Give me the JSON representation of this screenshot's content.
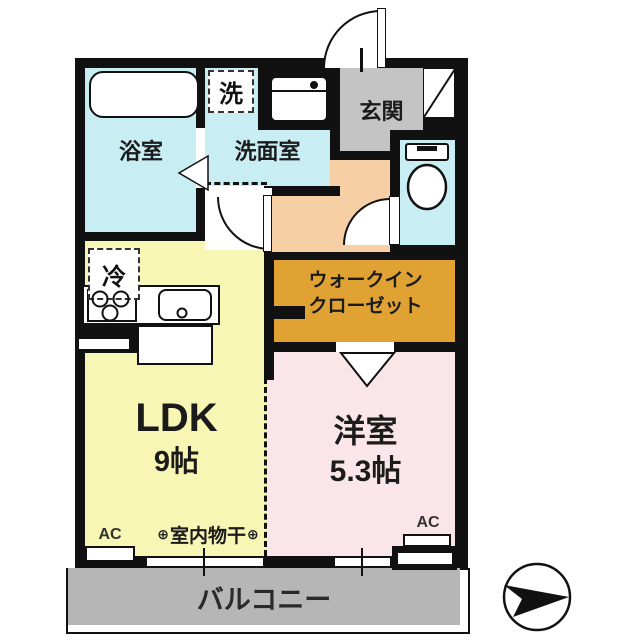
{
  "floorplan": {
    "rooms": {
      "bathroom": "浴室",
      "washroom": "洗面室",
      "laundry": "洗",
      "entrance": "玄関",
      "refrigerator": "冷",
      "ldk_name": "LDK",
      "ldk_size": "9帖",
      "wic_line1": "ウォークイン",
      "wic_line2": "クローゼット",
      "western_name": "洋室",
      "western_size": "5.3帖",
      "balcony": "バルコニー"
    },
    "annotations": {
      "ac": "AC",
      "indoor_drying": "室内物干",
      "drying_symbol": "⊕"
    },
    "colors": {
      "wall": "#111111",
      "water_rooms": "#c8edf2",
      "ldk": "#f7f6b4",
      "western_room": "#fae6e9",
      "hallway": "#f6cfa4",
      "walk_in_closet": "#e0a232",
      "entrance_floor": "#c4c4c4",
      "balcony": "#b6b6b6"
    }
  }
}
